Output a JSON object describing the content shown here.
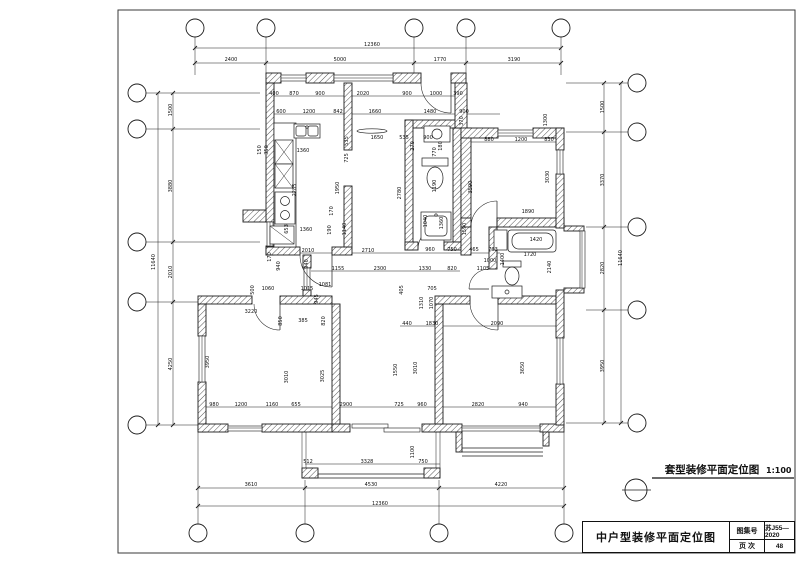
{
  "sheet": {
    "background": "#ffffff",
    "line_color": "#1c1c1c"
  },
  "caption": {
    "symbol": "detail-circle",
    "text": "套型装修平面定位图",
    "scale": "1:100"
  },
  "title_block": {
    "title": "中户型装修平面定位图",
    "fields": [
      {
        "label": "图集号",
        "value": "苏J55—2020"
      },
      {
        "label": "页 次",
        "value": "48"
      }
    ]
  },
  "plan": {
    "axis_bubbles": {
      "top": 5,
      "bottom": 4,
      "left": 5,
      "right": 5
    },
    "dimensions": [
      {
        "t": "12360",
        "x": 372,
        "y": 46
      },
      {
        "t": "2400",
        "x": 231,
        "y": 61
      },
      {
        "t": "5000",
        "x": 340,
        "y": 61
      },
      {
        "t": "1770",
        "x": 440,
        "y": 61
      },
      {
        "t": "3190",
        "x": 514,
        "y": 61
      },
      {
        "t": "400",
        "x": 274,
        "y": 95
      },
      {
        "t": "870",
        "x": 294,
        "y": 95
      },
      {
        "t": "900",
        "x": 320,
        "y": 95
      },
      {
        "t": "2020",
        "x": 363,
        "y": 95
      },
      {
        "t": "900",
        "x": 407,
        "y": 95
      },
      {
        "t": "1000",
        "x": 436,
        "y": 95
      },
      {
        "t": "390",
        "x": 458,
        "y": 95
      },
      {
        "t": "600",
        "x": 281,
        "y": 113
      },
      {
        "t": "1200",
        "x": 309,
        "y": 113
      },
      {
        "t": "842",
        "x": 338,
        "y": 113
      },
      {
        "t": "1660",
        "x": 375,
        "y": 113
      },
      {
        "t": "1480",
        "x": 430,
        "y": 113
      },
      {
        "t": "900",
        "x": 464,
        "y": 113
      },
      {
        "t": "370",
        "x": 463,
        "y": 121,
        "r": 1
      },
      {
        "t": "1300",
        "x": 547,
        "y": 120,
        "r": 1
      },
      {
        "t": "880",
        "x": 489,
        "y": 141
      },
      {
        "t": "1200",
        "x": 521,
        "y": 141
      },
      {
        "t": "830",
        "x": 549,
        "y": 141
      },
      {
        "t": "1500",
        "x": 172,
        "y": 110,
        "r": 1
      },
      {
        "t": "3880",
        "x": 172,
        "y": 186,
        "r": 1
      },
      {
        "t": "2010",
        "x": 172,
        "y": 272,
        "r": 1
      },
      {
        "t": "4250",
        "x": 172,
        "y": 364,
        "r": 1
      },
      {
        "t": "11640",
        "x": 155,
        "y": 262,
        "r": 1
      },
      {
        "t": "1500",
        "x": 604,
        "y": 107,
        "r": 1
      },
      {
        "t": "3370",
        "x": 604,
        "y": 180,
        "r": 1
      },
      {
        "t": "2820",
        "x": 604,
        "y": 268,
        "r": 1
      },
      {
        "t": "3950",
        "x": 604,
        "y": 366,
        "r": 1
      },
      {
        "t": "11640",
        "x": 622,
        "y": 258,
        "r": 1
      },
      {
        "t": "150",
        "x": 261,
        "y": 150,
        "r": 1
      },
      {
        "t": "350",
        "x": 268,
        "y": 150,
        "r": 1
      },
      {
        "t": "1360",
        "x": 303,
        "y": 152
      },
      {
        "t": "535",
        "x": 348,
        "y": 141,
        "r": 1
      },
      {
        "t": "725",
        "x": 348,
        "y": 158,
        "r": 1
      },
      {
        "t": "2285",
        "x": 296,
        "y": 190,
        "r": 1
      },
      {
        "t": "1950",
        "x": 339,
        "y": 188,
        "r": 1
      },
      {
        "t": "170",
        "x": 333,
        "y": 211,
        "r": 1
      },
      {
        "t": "653",
        "x": 288,
        "y": 229,
        "r": 1
      },
      {
        "t": "1360",
        "x": 306,
        "y": 231
      },
      {
        "t": "190",
        "x": 331,
        "y": 230,
        "r": 1
      },
      {
        "t": "1140",
        "x": 346,
        "y": 229,
        "r": 1
      },
      {
        "t": "2010",
        "x": 308,
        "y": 252
      },
      {
        "t": "170",
        "x": 271,
        "y": 257,
        "r": 1
      },
      {
        "t": "940",
        "x": 280,
        "y": 266,
        "r": 1
      },
      {
        "t": "1650",
        "x": 377,
        "y": 139
      },
      {
        "t": "535",
        "x": 404,
        "y": 139
      },
      {
        "t": "270",
        "x": 414,
        "y": 146,
        "r": 1
      },
      {
        "t": "900",
        "x": 428,
        "y": 139
      },
      {
        "t": "180",
        "x": 442,
        "y": 146,
        "r": 1
      },
      {
        "t": "2780",
        "x": 401,
        "y": 193,
        "r": 1
      },
      {
        "t": "770",
        "x": 436,
        "y": 152,
        "r": 1
      },
      {
        "t": "1190",
        "x": 436,
        "y": 186,
        "r": 1
      },
      {
        "t": "1040",
        "x": 427,
        "y": 221,
        "r": 1
      },
      {
        "t": "1360",
        "x": 443,
        "y": 223,
        "r": 1
      },
      {
        "t": "1590",
        "x": 466,
        "y": 229,
        "r": 1
      },
      {
        "t": "3590",
        "x": 472,
        "y": 187,
        "r": 1
      },
      {
        "t": "3030",
        "x": 549,
        "y": 177,
        "r": 1
      },
      {
        "t": "1890",
        "x": 528,
        "y": 213
      },
      {
        "t": "1420",
        "x": 536,
        "y": 241
      },
      {
        "t": "1720",
        "x": 530,
        "y": 256
      },
      {
        "t": "1000",
        "x": 490,
        "y": 262
      },
      {
        "t": "2140",
        "x": 551,
        "y": 267,
        "r": 1
      },
      {
        "t": "2710",
        "x": 368,
        "y": 252
      },
      {
        "t": "960",
        "x": 430,
        "y": 251
      },
      {
        "t": "750",
        "x": 452,
        "y": 251
      },
      {
        "t": "465",
        "x": 474,
        "y": 251
      },
      {
        "t": "793",
        "x": 493,
        "y": 251
      },
      {
        "t": "1400",
        "x": 504,
        "y": 259,
        "r": 1
      },
      {
        "t": "940",
        "x": 308,
        "y": 264,
        "r": 1
      },
      {
        "t": "1155",
        "x": 338,
        "y": 270
      },
      {
        "t": "2300",
        "x": 380,
        "y": 270
      },
      {
        "t": "1330",
        "x": 425,
        "y": 270
      },
      {
        "t": "820",
        "x": 452,
        "y": 270
      },
      {
        "t": "1105",
        "x": 483,
        "y": 270
      },
      {
        "t": "1081",
        "x": 325,
        "y": 286
      },
      {
        "t": "945",
        "x": 318,
        "y": 299,
        "r": 1
      },
      {
        "t": "405",
        "x": 403,
        "y": 290,
        "r": 1
      },
      {
        "t": "705",
        "x": 432,
        "y": 290
      },
      {
        "t": "1070",
        "x": 433,
        "y": 303,
        "r": 1
      },
      {
        "t": "1310",
        "x": 423,
        "y": 303,
        "r": 1
      },
      {
        "t": "440",
        "x": 407,
        "y": 325
      },
      {
        "t": "1830",
        "x": 432,
        "y": 325
      },
      {
        "t": "2090",
        "x": 497,
        "y": 325
      },
      {
        "t": "1550",
        "x": 397,
        "y": 370,
        "r": 1
      },
      {
        "t": "3010",
        "x": 417,
        "y": 368,
        "r": 1
      },
      {
        "t": "3650",
        "x": 524,
        "y": 368,
        "r": 1
      },
      {
        "t": "3220",
        "x": 251,
        "y": 313
      },
      {
        "t": "850",
        "x": 282,
        "y": 321,
        "r": 1
      },
      {
        "t": "385",
        "x": 303,
        "y": 322
      },
      {
        "t": "820",
        "x": 325,
        "y": 321,
        "r": 1
      },
      {
        "t": "500",
        "x": 254,
        "y": 290,
        "r": 1
      },
      {
        "t": "1060",
        "x": 268,
        "y": 290
      },
      {
        "t": "1015",
        "x": 307,
        "y": 290
      },
      {
        "t": "3950",
        "x": 209,
        "y": 362,
        "r": 1
      },
      {
        "t": "3010",
        "x": 288,
        "y": 377,
        "r": 1
      },
      {
        "t": "3025",
        "x": 324,
        "y": 376,
        "r": 1
      },
      {
        "t": "980",
        "x": 214,
        "y": 406
      },
      {
        "t": "1200",
        "x": 241,
        "y": 406
      },
      {
        "t": "1160",
        "x": 272,
        "y": 406
      },
      {
        "t": "655",
        "x": 296,
        "y": 406
      },
      {
        "t": "2900",
        "x": 346,
        "y": 406
      },
      {
        "t": "725",
        "x": 399,
        "y": 406
      },
      {
        "t": "960",
        "x": 422,
        "y": 406
      },
      {
        "t": "2820",
        "x": 478,
        "y": 406
      },
      {
        "t": "940",
        "x": 523,
        "y": 406
      },
      {
        "t": "512",
        "x": 308,
        "y": 463
      },
      {
        "t": "3328",
        "x": 367,
        "y": 463
      },
      {
        "t": "750",
        "x": 423,
        "y": 463
      },
      {
        "t": "1100",
        "x": 414,
        "y": 452,
        "r": 1
      },
      {
        "t": "3610",
        "x": 251,
        "y": 486
      },
      {
        "t": "4530",
        "x": 371,
        "y": 486
      },
      {
        "t": "4220",
        "x": 501,
        "y": 486
      },
      {
        "t": "12360",
        "x": 380,
        "y": 505
      }
    ]
  }
}
